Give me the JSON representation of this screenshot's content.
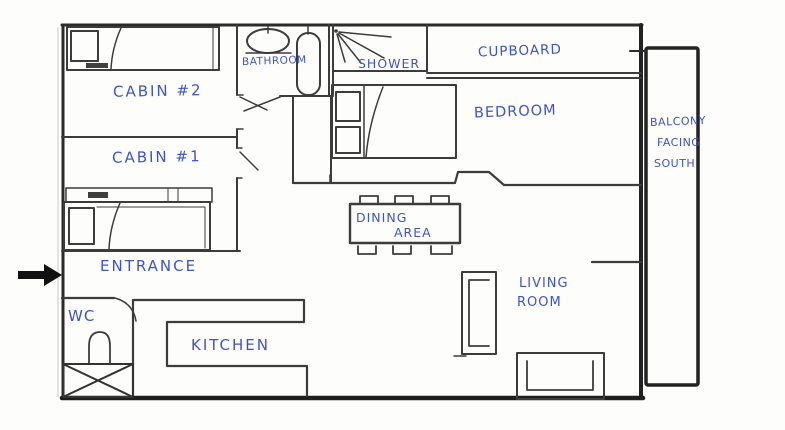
{
  "floorplan": {
    "labels": {
      "cabin2": "CABIN #2",
      "cabin1": "CABIN #1",
      "bathroom": "BATHROOM",
      "shower": "SHOWER",
      "cupboard": "CUPBOARD",
      "bedroom": "BEDROOM",
      "balcony_line1": "BALCONY",
      "balcony_line2": "FACING",
      "balcony_line3": "SOUTH",
      "dining_line1": "DINING",
      "dining_line2": "AREA",
      "living_line1": "LIVING",
      "living_line2": "ROOM",
      "entrance": "ENTRANCE",
      "wc": "WC",
      "kitchen": "KITCHEN"
    },
    "colors": {
      "ink": "#3c3c3c",
      "heavy_wall": "#222222",
      "label_ink": "#3f54c2",
      "paper": "#fdfdfb",
      "arrow": "#111111"
    },
    "furniture": [
      {
        "name": "single-bed",
        "room": "CABIN #2"
      },
      {
        "name": "nightstand",
        "room": "CABIN #2"
      },
      {
        "name": "single-bed",
        "room": "CABIN #1"
      },
      {
        "name": "nightstand",
        "room": "CABIN #1"
      },
      {
        "name": "sink",
        "room": "BATHROOM"
      },
      {
        "name": "bathtub",
        "room": "BATHROOM"
      },
      {
        "name": "shower-spray",
        "room": "SHOWER"
      },
      {
        "name": "double-bed-with-pillows",
        "room": "BEDROOM"
      },
      {
        "name": "table-with-six-chairs",
        "room": "DINING AREA"
      },
      {
        "name": "sofa-vertical",
        "room": "LIVING ROOM"
      },
      {
        "name": "sofa-horizontal",
        "room": "LIVING ROOM"
      },
      {
        "name": "c-shaped-counter",
        "room": "KITCHEN"
      },
      {
        "name": "toilet",
        "room": "WC"
      },
      {
        "name": "crossed-box",
        "room": "ENTRANCE"
      }
    ],
    "entrance_arrow": {
      "direction": "right"
    }
  }
}
